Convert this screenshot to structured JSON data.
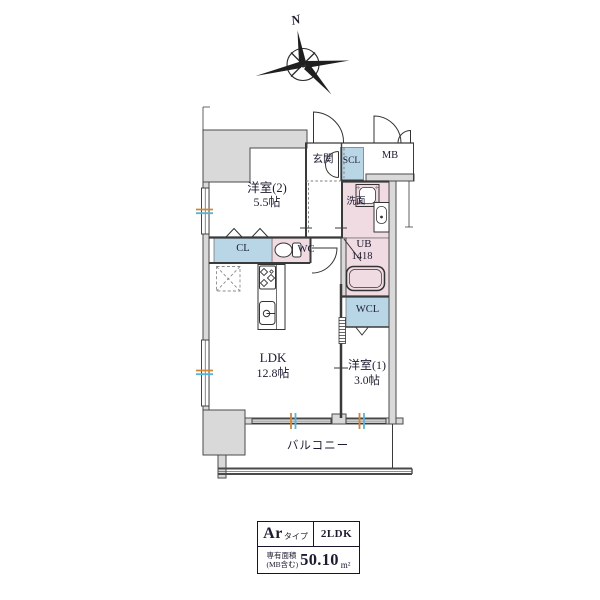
{
  "compass": {
    "north_label": "N"
  },
  "plan": {
    "rooms": {
      "yoshitsu2": {
        "name": "洋室(2)",
        "size": "5.5帖"
      },
      "yoshitsu1": {
        "name": "洋室(1)",
        "size": "3.0帖"
      },
      "ldk": {
        "name": "LDK",
        "size": "12.8帖"
      },
      "balcony": {
        "name": "バルコニー"
      },
      "genkan": {
        "name": "玄関"
      },
      "scl": {
        "name": "SCL"
      },
      "mb": {
        "name": "MB"
      },
      "senmen": {
        "name": "洗面"
      },
      "cl": {
        "name": "CL"
      },
      "wc": {
        "name": "WC"
      },
      "ub": {
        "name": "UB",
        "size": "1418"
      },
      "wcl": {
        "name": "WCL"
      }
    }
  },
  "info_table": {
    "type_value": "Ar",
    "type_suffix": "タイプ",
    "layout": "2LDK",
    "area_label_line1": "専有面積",
    "area_label_line2": "(MB含む)",
    "area_value": "50.10",
    "area_unit": "m²"
  },
  "colors": {
    "wet_pink": "#f1dbe3",
    "closet_blue": "#b9d6e7",
    "wall_gray": "#d9d9d9",
    "line": "#3a3a3a",
    "sash_orange": "#d08738",
    "sash_blue": "#58b4d8"
  }
}
